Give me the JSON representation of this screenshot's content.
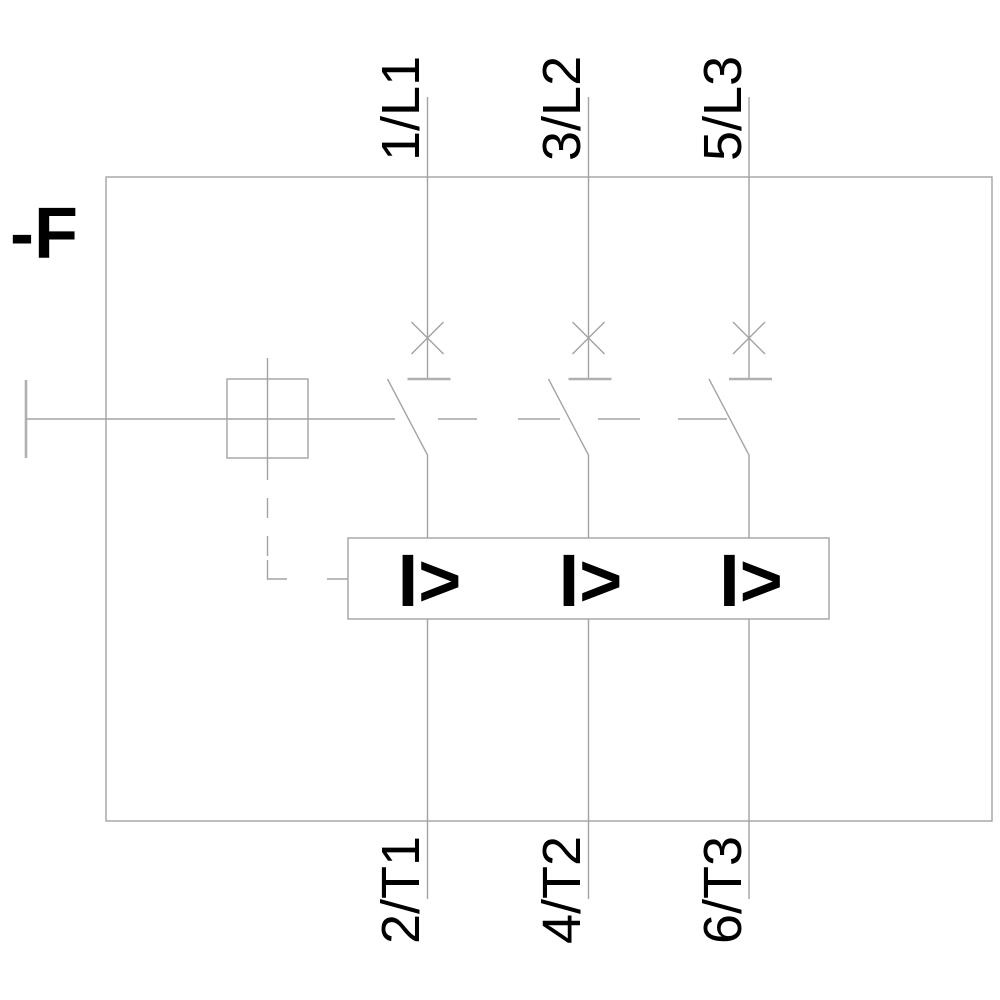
{
  "diagram": {
    "kind": "3-pole circuit breaker / motor starter protector schematic",
    "device_label": "-F",
    "overcurrent_symbol": "I>",
    "terminals": {
      "top": [
        "1/L1",
        "3/L2",
        "5/L3"
      ],
      "bottom": [
        "2/T1",
        "4/T2",
        "6/T3"
      ]
    },
    "colors": {
      "line": "#a3a3a3",
      "text": "#000000",
      "background": "#ffffff"
    }
  }
}
